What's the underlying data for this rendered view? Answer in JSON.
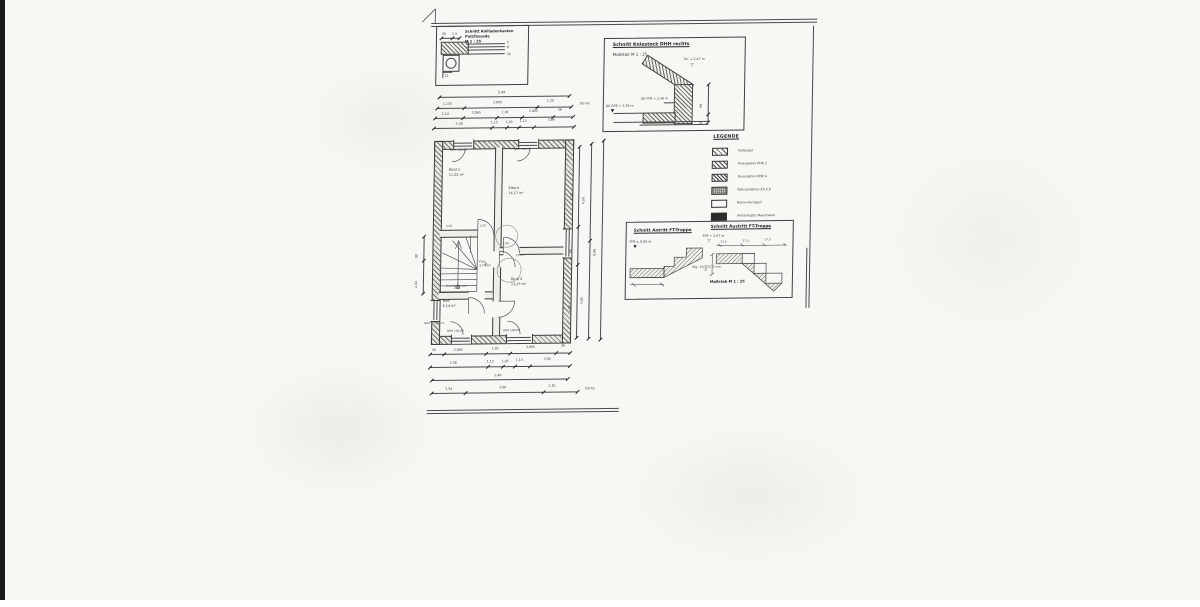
{
  "rollladen_detail": {
    "title1": "Schnitt Rollladenkasten",
    "title2": "Putzfassade",
    "title3": "M 1 : 25",
    "dim_width": "36",
    "dim_edge": "1,5",
    "leader1": "2",
    "leader2": "8",
    "leader3": "36",
    "dim_bottom": "12"
  },
  "kniestock_detail": {
    "title": "Schnitt Kniestock DHH rechts",
    "scale": "Maßstab M 1 : 25",
    "level_ridge": "Tol. + 2,47 m",
    "level_ffb": "OK FFB + 2,36 m",
    "level_rfb": "OK RFB + 2,29 m",
    "dim_upper": "88",
    "dim_lower": "18",
    "marker_open": "▽",
    "marker_filled": "▼"
  },
  "legend": {
    "title": "LEGENDE",
    "items": [
      {
        "label": "Vollziegel"
      },
      {
        "label": "Porenbeton PPW 2"
      },
      {
        "label": "Porenbeton PPW 4"
      },
      {
        "label": "Kalksandstein KS 4,0"
      },
      {
        "label": "Beton-Fertigteil"
      },
      {
        "label": "Hinterlegtes Mauerwerk"
      }
    ]
  },
  "stair_details": {
    "antritt_title": "Schnitt Antritt FT-Treppe",
    "austritt_title": "Schnitt Austritt FT-Treppe",
    "antritt_level": "FFB ± 0,00 m",
    "austritt_level": "FFB + 2,67 m",
    "tread1": "27,5",
    "tread2": "27,5",
    "tread3": "27,5",
    "riser": "16,7",
    "note": "Stg. 16,7/27,5 cm",
    "scale": "Maßstab M 1 : 25",
    "marker_open": "▽",
    "marker_filled": "▼"
  },
  "floor_plan": {
    "rooms": {
      "kind1": {
        "name": "Kind 1",
        "area": "11,22 m²"
      },
      "eltern": {
        "name": "Eltern",
        "area": "14,17 m²"
      },
      "kind2": {
        "name": "Kind 2",
        "area": "13,23 m²"
      },
      "bad": {
        "name": "Bad",
        "area": "6,14 m²"
      },
      "flur": {
        "name": "Flur",
        "area": "3,74 m²"
      }
    },
    "stair_label": "Geschoßtreppe",
    "brh_top": "BRH 102,06",
    "brh_bottom": "BRH 100,06",
    "brh_left": "BRH 77/59 cm",
    "inner_dims": [
      "2,26",
      "1,01",
      "2,04",
      "1,135",
      "88",
      "2,38"
    ]
  },
  "dim_chains": {
    "top": {
      "row1": [
        "5,49"
      ],
      "row2": [
        "1,135",
        "3,065",
        "1,29"
      ],
      "row3": [
        "1,14",
        "2,065",
        "1,01",
        "2,065",
        "36"
      ],
      "row4": [
        "2,38",
        "1,13",
        "1,05",
        "1,13",
        "3,06"
      ],
      "side_label": "Decke"
    },
    "bottom": {
      "rowA": [
        "36",
        "2,065",
        "1,01",
        "3,065",
        "36"
      ],
      "rowB": [
        "2,38",
        "1,13",
        "1,05",
        "1,13",
        "3,06"
      ],
      "rowC": [
        "5,49"
      ],
      "rowD": [
        "1,54",
        "3,06",
        "1,30"
      ],
      "side_label": "Decke"
    },
    "right": [
      "2,53",
      "88",
      "2,04",
      "4,06",
      "4,88",
      "9,99"
    ],
    "left": [
      "88",
      "2,04"
    ]
  }
}
